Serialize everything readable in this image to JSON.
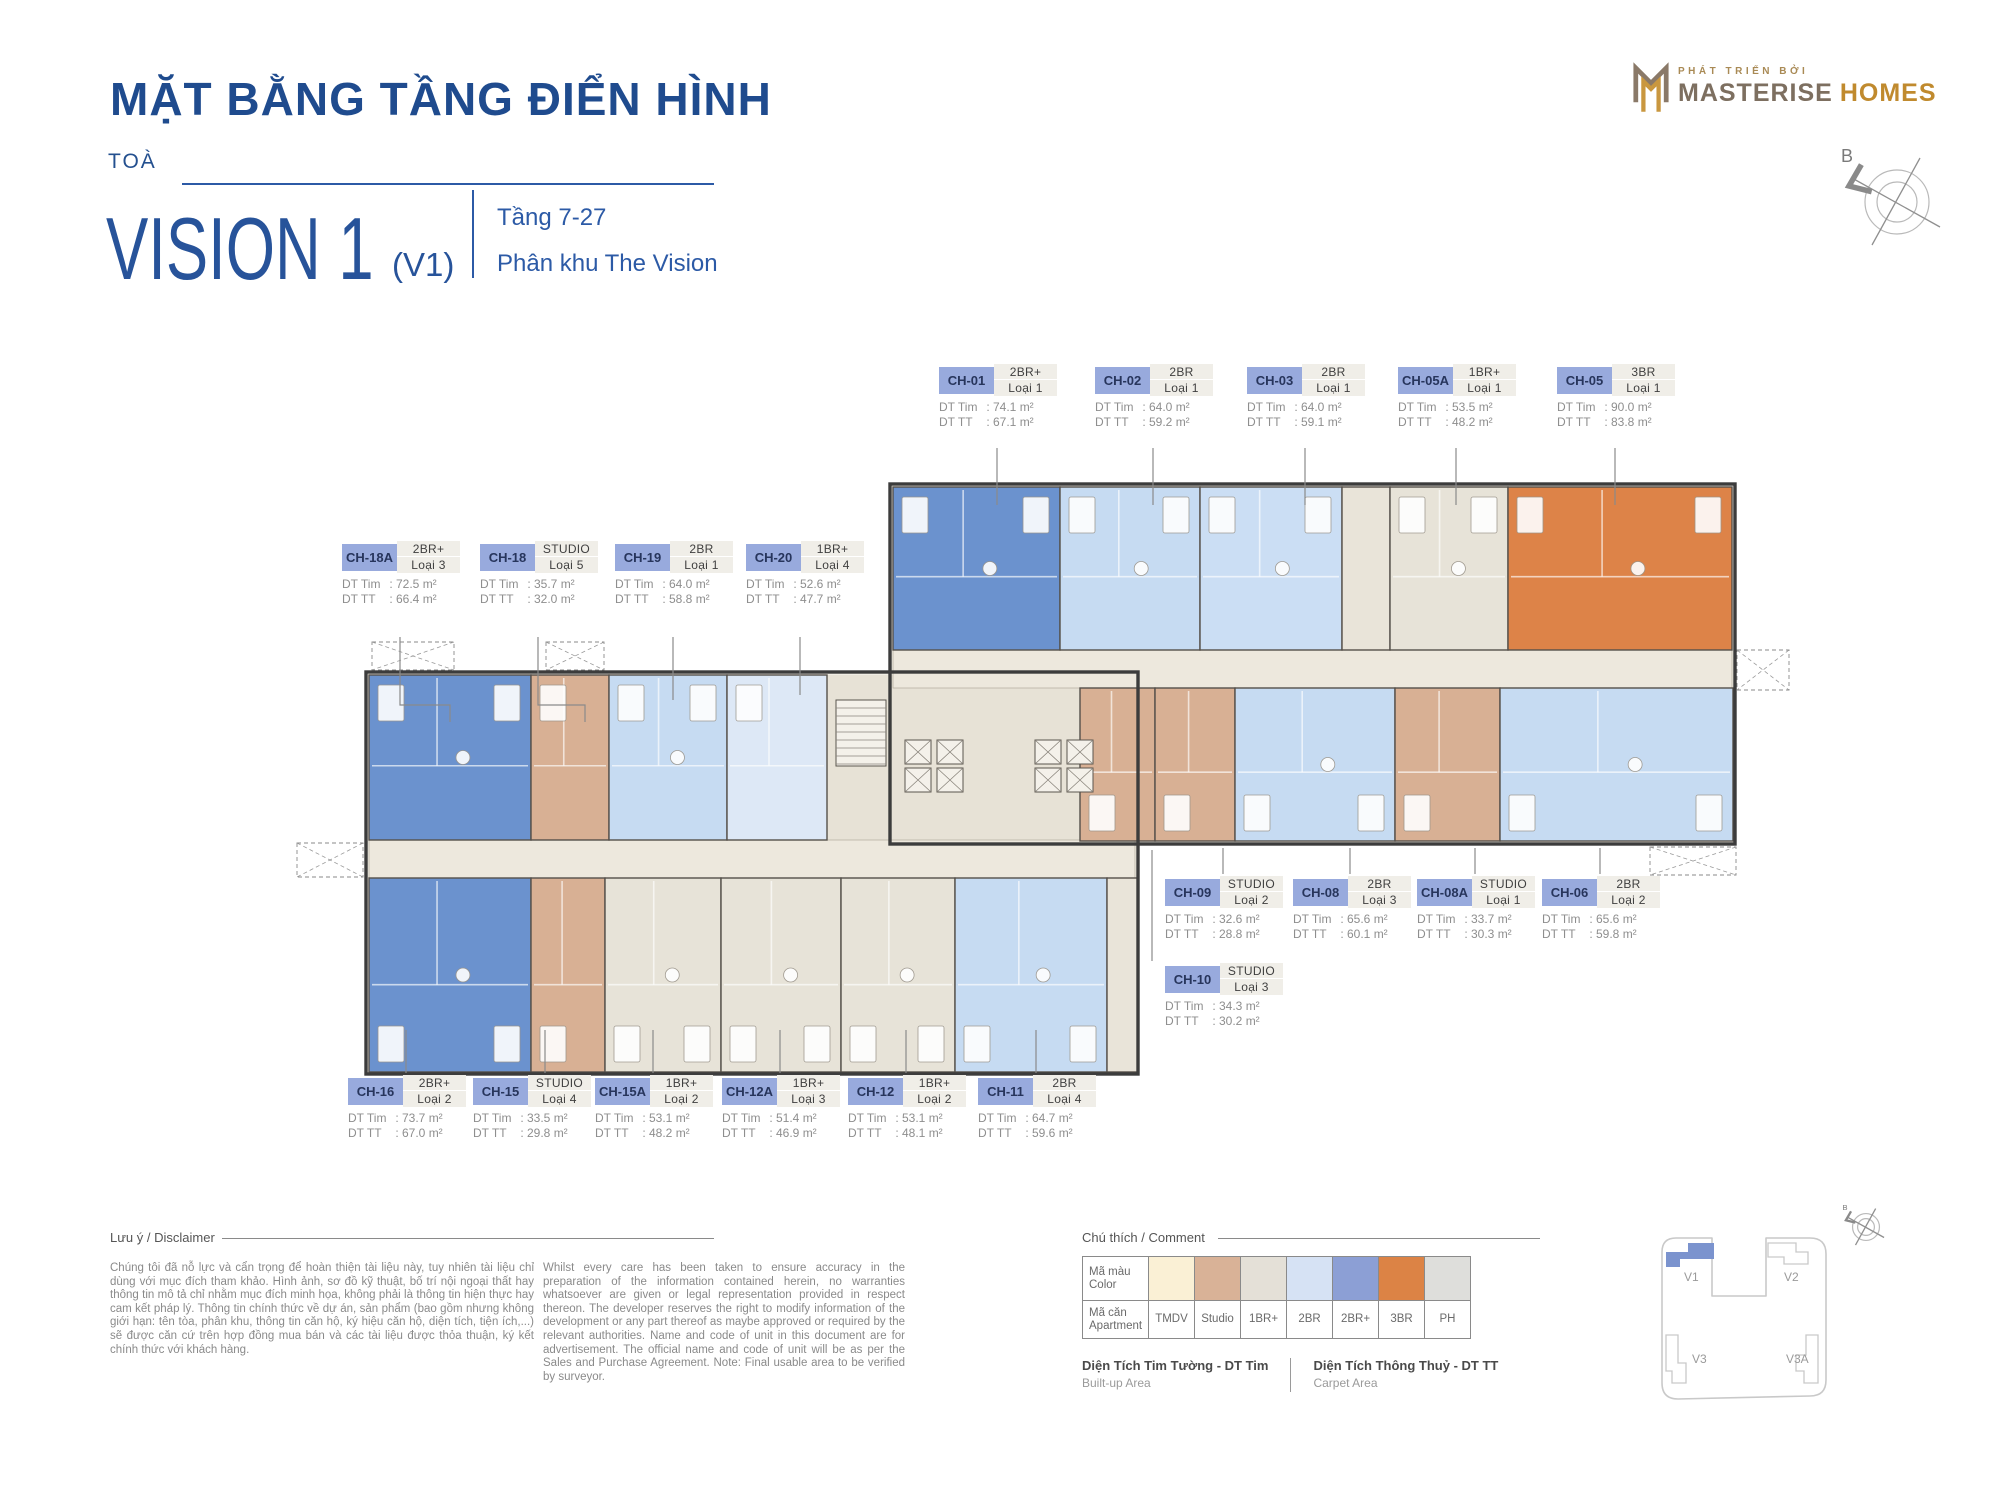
{
  "header": {
    "title": "MẶT BẰNG TẦNG ĐIỂN HÌNH",
    "tower_prefix": "TOÀ",
    "tower_name": "VISION 1",
    "tower_code": "(V1)",
    "floor_range": "Tầng 7-27",
    "zone": "Phân khu The Vision"
  },
  "developer": {
    "tagline": "PHÁT TRIỂN BỞI",
    "name_primary": "MASTERISE",
    "name_secondary": "HOMES"
  },
  "compass": {
    "north_label": "B"
  },
  "area_labels": {
    "tim": "DT Tim",
    "tt": "DT TT"
  },
  "units": [
    {
      "code": "CH-01",
      "type": "2BR+",
      "variant": "Loại 1",
      "dt_tim": "74.1 m²",
      "dt_tt": "67.1 m²"
    },
    {
      "code": "CH-02",
      "type": "2BR",
      "variant": "Loại 1",
      "dt_tim": "64.0 m²",
      "dt_tt": "59.2 m²"
    },
    {
      "code": "CH-03",
      "type": "2BR",
      "variant": "Loại 1",
      "dt_tim": "64.0 m²",
      "dt_tt": "59.1 m²"
    },
    {
      "code": "CH-05A",
      "type": "1BR+",
      "variant": "Loại 1",
      "dt_tim": "53.5 m²",
      "dt_tt": "48.2 m²"
    },
    {
      "code": "CH-05",
      "type": "3BR",
      "variant": "Loại 1",
      "dt_tim": "90.0 m²",
      "dt_tt": "83.8 m²"
    },
    {
      "code": "CH-18A",
      "type": "2BR+",
      "variant": "Loại 3",
      "dt_tim": "72.5 m²",
      "dt_tt": "66.4 m²"
    },
    {
      "code": "CH-18",
      "type": "STUDIO",
      "variant": "Loại 5",
      "dt_tim": "35.7 m²",
      "dt_tt": "32.0 m²"
    },
    {
      "code": "CH-19",
      "type": "2BR",
      "variant": "Loại 1",
      "dt_tim": "64.0 m²",
      "dt_tt": "58.8 m²"
    },
    {
      "code": "CH-20",
      "type": "1BR+",
      "variant": "Loại 4",
      "dt_tim": "52.6 m²",
      "dt_tt": "47.7 m²"
    },
    {
      "code": "CH-09",
      "type": "STUDIO",
      "variant": "Loại 2",
      "dt_tim": "32.6 m²",
      "dt_tt": "28.8 m²"
    },
    {
      "code": "CH-08",
      "type": "2BR",
      "variant": "Loại 3",
      "dt_tim": "65.6 m²",
      "dt_tt": "60.1 m²"
    },
    {
      "code": "CH-08A",
      "type": "STUDIO",
      "variant": "Loại 1",
      "dt_tim": "33.7 m²",
      "dt_tt": "30.3 m²"
    },
    {
      "code": "CH-06",
      "type": "2BR",
      "variant": "Loại 2",
      "dt_tim": "65.6 m²",
      "dt_tt": "59.8 m²"
    },
    {
      "code": "CH-10",
      "type": "STUDIO",
      "variant": "Loại 3",
      "dt_tim": "34.3 m²",
      "dt_tt": "30.2 m²"
    },
    {
      "code": "CH-16",
      "type": "2BR+",
      "variant": "Loại 2",
      "dt_tim": "73.7 m²",
      "dt_tt": "67.0 m²"
    },
    {
      "code": "CH-15",
      "type": "STUDIO",
      "variant": "Loại 4",
      "dt_tim": "33.5 m²",
      "dt_tt": "29.8 m²"
    },
    {
      "code": "CH-15A",
      "type": "1BR+",
      "variant": "Loại 2",
      "dt_tim": "53.1 m²",
      "dt_tt": "48.2 m²"
    },
    {
      "code": "CH-12A",
      "type": "1BR+",
      "variant": "Loại 3",
      "dt_tim": "51.4 m²",
      "dt_tt": "46.9 m²"
    },
    {
      "code": "CH-12",
      "type": "1BR+",
      "variant": "Loại 2",
      "dt_tim": "53.1 m²",
      "dt_tt": "48.1 m²"
    },
    {
      "code": "CH-11",
      "type": "2BR",
      "variant": "Loại 4",
      "dt_tim": "64.7 m²",
      "dt_tt": "59.6 m²"
    }
  ],
  "disclaimer": {
    "heading": "Lưu ý / Disclaimer",
    "text_vi": "Chúng tôi đã nỗ lực và cẩn trọng để hoàn thiện tài liệu này, tuy nhiên tài liệu chỉ dùng với mục đích tham khảo. Hình ảnh, sơ đồ kỹ thuật, bố trí nội ngoại thất hay thông tin mô tả chỉ nhằm mục đích minh họa, không phải là thông tin hiện thực hay cam kết pháp lý. Thông tin chính thức về dự án, sản phẩm (bao gồm nhưng không giới hạn: tên tòa, phân khu, thông tin căn hộ, ký hiệu căn hộ, diện tích, tiện ích,...) sẽ được căn cứ trên hợp đồng mua bán và các tài liệu được thỏa thuận, ký kết chính thức với khách hàng.",
    "text_en": "Whilst every care has been taken to ensure accuracy in the preparation of the information contained herein, no warranties whatsoever are given or legal representation provided in respect thereon. The developer reserves the right to modify information of the development or any part thereof as maybe approved or required by the relevant authorities. Name and code of unit in this document are for advertisement. The official name and code of unit will be as per the Sales and Purchase Agreement. Note: Final usable area to be verified by surveyor."
  },
  "legend": {
    "heading": "Chú thích / Comment",
    "color_row_label_vi": "Mã màu",
    "color_row_label_en": "Color",
    "apartment_row_label_vi": "Mã căn",
    "apartment_row_label_en": "Apartment",
    "types": [
      {
        "label": "TMDV",
        "color": "#FAF0D5"
      },
      {
        "label": "Studio",
        "color": "#D9B297"
      },
      {
        "label": "1BR+",
        "color": "#E4E0D7"
      },
      {
        "label": "2BR",
        "color": "#D6E2F4"
      },
      {
        "label": "2BR+",
        "color": "#8C9FD5"
      },
      {
        "label": "3BR",
        "color": "#DC8345"
      },
      {
        "label": "PH",
        "color": "#DEDEDB"
      }
    ],
    "builtup": {
      "vi": "Diện Tích Tim Tường - DT Tim",
      "en": "Built-up Area"
    },
    "carpet": {
      "vi": "Diện Tích Thông Thuỷ - DT TT",
      "en": "Carpet Area"
    }
  },
  "minimap": {
    "blocks": [
      "V1",
      "V2",
      "V3",
      "V3A"
    ],
    "highlighted": "V1",
    "highlight_color": "#7B93CE",
    "north_label": "B"
  }
}
